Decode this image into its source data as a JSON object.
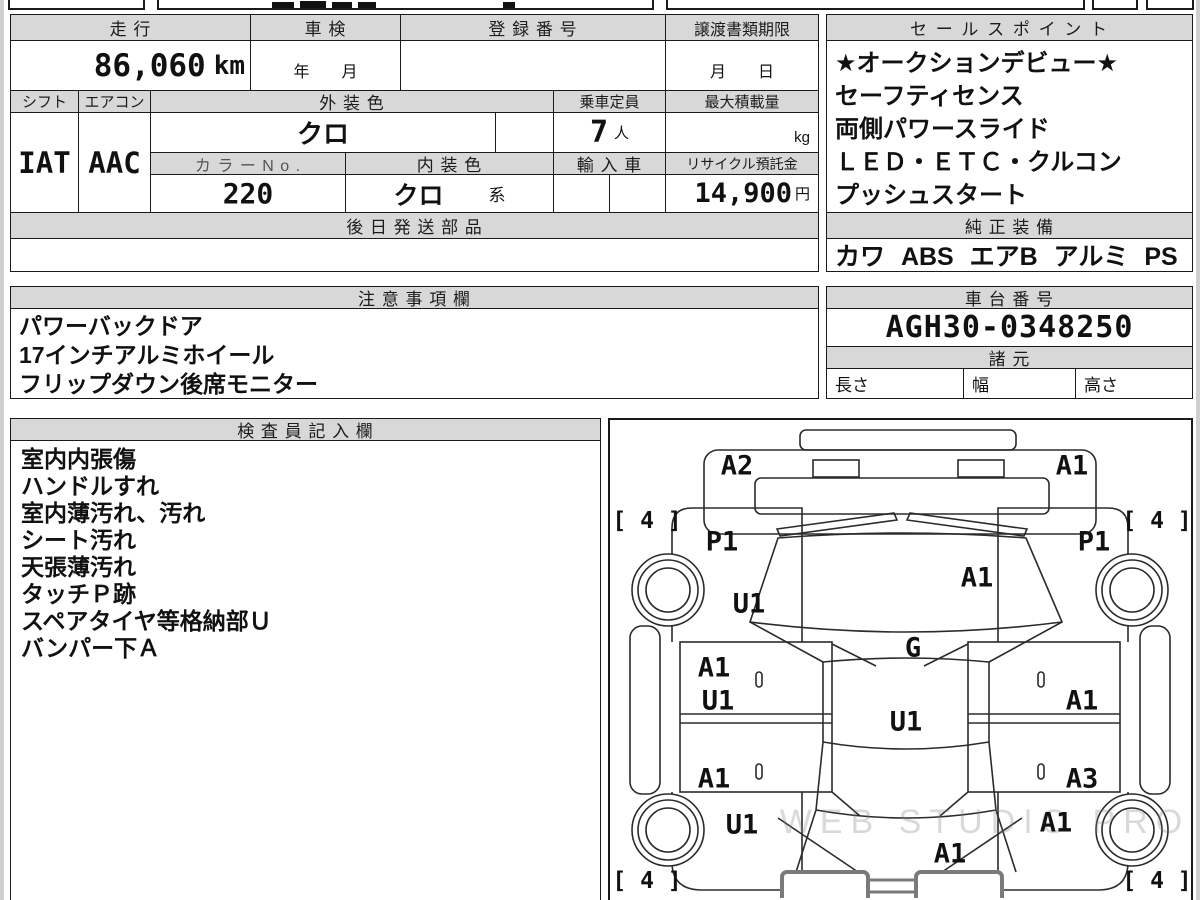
{
  "colors": {
    "header_bg": "#d8d8d8",
    "border": "#1a1a1a",
    "text": "#111111"
  },
  "top_table": {
    "mileage_label": "走 行",
    "mileage_value": "86,060",
    "mileage_unit": "km",
    "inspection_label": "車 検",
    "inspection_value": "年　　月",
    "registration_label": "登 録 番 号",
    "registration_value": "",
    "transfer_label": "譲渡書類期限",
    "transfer_value": "月　　日",
    "shift_label": "シフト",
    "shift_value": "IAT",
    "aircon_label": "エアコン",
    "aircon_value": "AAC",
    "exterior_color_label": "外 装 色",
    "exterior_color_value": "クロ",
    "capacity_label": "乗車定員",
    "capacity_value": "7",
    "capacity_unit": "人",
    "max_load_label": "最大積載量",
    "max_load_unit": "kg",
    "color_no_label": "カ ラ ー N o .",
    "color_no_value": "220",
    "interior_color_label": "内 装 色",
    "interior_color_value": "クロ",
    "interior_color_suffix": "系",
    "import_label": "輸 入 車",
    "recycle_label": "リサイクル預託金",
    "recycle_value": "14,900",
    "recycle_unit": "円",
    "later_shipping_label": "後 日 発 送 部 品"
  },
  "sales_points": {
    "title": "セ ー ル ス ポ イ ン ト",
    "items": [
      "★オークションデビュー★",
      "セーフティセンス",
      "両側パワースライド",
      "ＬＥＤ・ＥＴＣ・クルコン",
      "プッシュスタート"
    ]
  },
  "genuine_equipment": {
    "title": "純 正 装 備",
    "value": "カワ ABS エアB アルミ PS PW"
  },
  "notes": {
    "title": "注 意 事 項 欄",
    "items": [
      "パワーバックドア",
      "17インチアルミホイール",
      "フリップダウン後席モニター"
    ]
  },
  "chassis": {
    "title": "車 台 番 号",
    "value": "AGH30-0348250"
  },
  "specs": {
    "title": "諸 元",
    "length_label": "長さ",
    "width_label": "幅",
    "height_label": "高さ"
  },
  "inspector": {
    "title": "検 査 員 記 入 欄",
    "items": [
      "室内内張傷",
      "ハンドルすれ",
      "室内薄汚れ、汚れ",
      "シート汚れ",
      "天張薄汚れ",
      "タッチＰ跡",
      "スペアタイヤ等格納部Ｕ",
      "バンパー下Ａ"
    ]
  },
  "diagram": {
    "watermark": "WEB STUDIO PRO",
    "tire_mark": "[ 4 ]",
    "tire_positions": [
      {
        "x": 37,
        "y": 101
      },
      {
        "x": 547,
        "y": 101
      },
      {
        "x": 37,
        "y": 461
      },
      {
        "x": 547,
        "y": 461
      }
    ],
    "labels": [
      {
        "t": "A2",
        "x": 127,
        "y": 46
      },
      {
        "t": "A1",
        "x": 462,
        "y": 46
      },
      {
        "t": "P1",
        "x": 112,
        "y": 122
      },
      {
        "t": "P1",
        "x": 484,
        "y": 122
      },
      {
        "t": "A1",
        "x": 367,
        "y": 158
      },
      {
        "t": "U1",
        "x": 139,
        "y": 184
      },
      {
        "t": "G",
        "x": 303,
        "y": 228
      },
      {
        "t": "A1",
        "x": 104,
        "y": 248
      },
      {
        "t": "U1",
        "x": 108,
        "y": 281
      },
      {
        "t": "A1",
        "x": 472,
        "y": 281
      },
      {
        "t": "U1",
        "x": 296,
        "y": 302
      },
      {
        "t": "A1",
        "x": 104,
        "y": 359
      },
      {
        "t": "A3",
        "x": 472,
        "y": 359
      },
      {
        "t": "U1",
        "x": 132,
        "y": 405
      },
      {
        "t": "A1",
        "x": 446,
        "y": 403
      },
      {
        "t": "A1",
        "x": 340,
        "y": 434
      }
    ]
  }
}
